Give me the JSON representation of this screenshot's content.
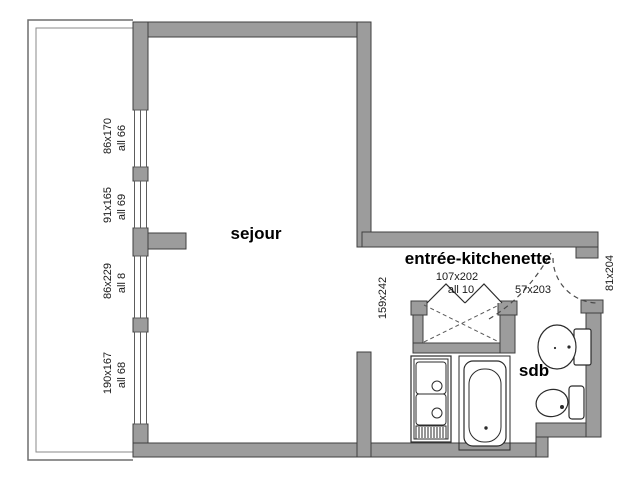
{
  "rooms": {
    "living": "sejour",
    "entry": "entrée-kitchenette",
    "bathroom": "sdb"
  },
  "windows": [
    {
      "dim": "86x170",
      "sill": "all 66"
    },
    {
      "dim": "91x165",
      "sill": "all 69"
    },
    {
      "dim": "86x229",
      "sill": "all 8"
    },
    {
      "dim": "190x167",
      "sill": "all 68"
    }
  ],
  "openings": {
    "closet_door_dim": "107x202",
    "closet_door_sill": "all 10",
    "bathroom_door_dim": "57x203",
    "passage_dim": "159x242",
    "entry_door_dim": "81x204"
  },
  "colors": {
    "wall_fill": "#9c9c9c",
    "wall_outline": "#3f3f3f",
    "fixture_line": "#2b2b2b",
    "background": "#ffffff"
  }
}
